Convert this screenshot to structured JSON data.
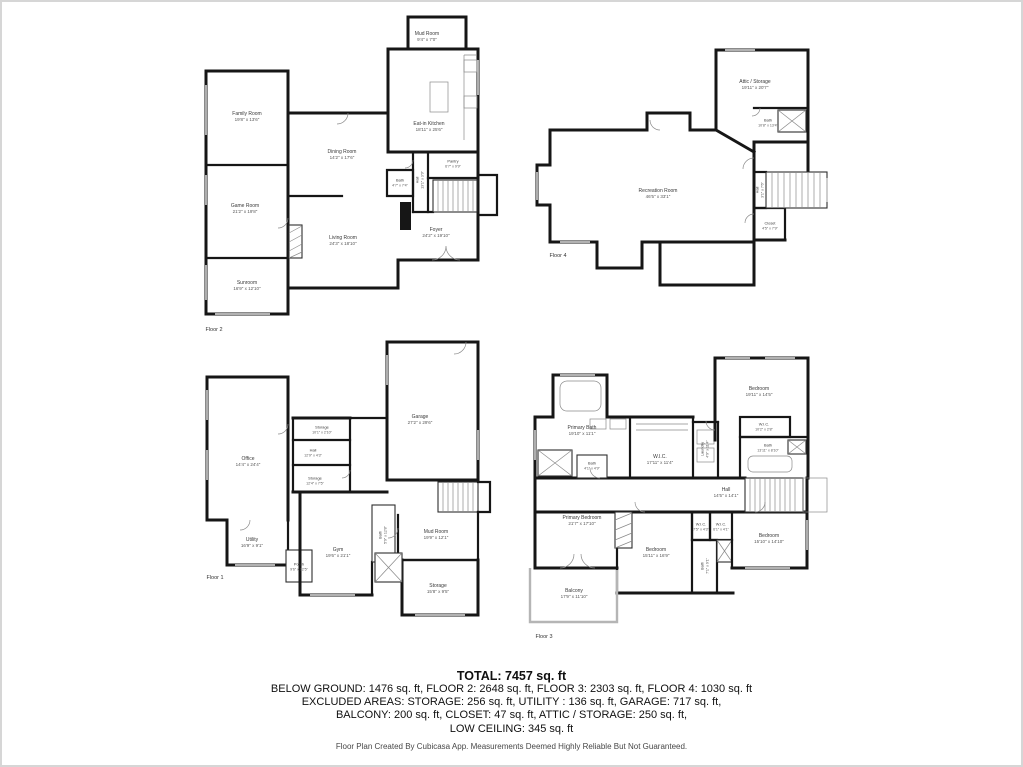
{
  "summary": {
    "total": "TOTAL: 7457 sq. ft",
    "line2": "BELOW GROUND: 1476 sq. ft, FLOOR 2: 2648 sq. ft, FLOOR 3: 2303 sq. ft, FLOOR 4: 1030 sq. ft",
    "line3": "EXCLUDED AREAS: STORAGE: 256 sq. ft, UTILITY : 136 sq. ft, GARAGE: 717 sq. ft,",
    "line4": "BALCONY: 200 sq. ft, CLOSET: 47 sq. ft, ATTIC / STORAGE: 250 sq. ft,",
    "line5": "LOW CEILING: 345 sq. ft"
  },
  "footer": "Floor Plan Created By Cubicasa App. Measurements Deemed Highly Reliable But Not Guaranteed.",
  "colors": {
    "wall": "#161616",
    "window_mark": "#c9c9c9",
    "light_wall": "#b5b5b5",
    "background": "#ffffff",
    "text": "#111111"
  },
  "floors": [
    {
      "label": "Floor 2",
      "rooms": [
        {
          "name": "Mud Room",
          "dims": "9'4\" x 7'0\""
        },
        {
          "name": "Eat-in Kitchen",
          "dims": "18'11\" x 25'6\""
        },
        {
          "name": "Family Room",
          "dims": "19'8\" x 13'6\""
        },
        {
          "name": "Dining Room",
          "dims": "14'2\" x 17'6\""
        },
        {
          "name": "Pantry",
          "dims": "6'7\" x 9'9\""
        },
        {
          "name": "Bath",
          "dims": "4'7\" x 7'4\""
        },
        {
          "name": "Hall",
          "dims": "13'1\" x 3'9\""
        },
        {
          "name": "Game Room",
          "dims": "21'2\" x 19'8\""
        },
        {
          "name": "Living Room",
          "dims": "24'3\" x 18'10\""
        },
        {
          "name": "Foyer",
          "dims": "24'2\" x 19'10\""
        },
        {
          "name": "Sunroom",
          "dims": "16'9\" x 12'10\""
        }
      ]
    },
    {
      "label": "Floor 4",
      "rooms": [
        {
          "name": "Attic / Storage",
          "dims": "19'11\" x 20'7\""
        },
        {
          "name": "Bath",
          "dims": "10'8\" x 13'4\""
        },
        {
          "name": "Recreation Room",
          "dims": "46'5\" x 33'1\""
        },
        {
          "name": "Hall",
          "dims": "3'1\" x 7'6\""
        },
        {
          "name": "Closet",
          "dims": "4'5\" x 7'9\""
        }
      ]
    },
    {
      "label": "Floor 1",
      "rooms": [
        {
          "name": "Office",
          "dims": "14'4\" x 24'4\""
        },
        {
          "name": "Garage",
          "dims": "27'2\" x 29'6\""
        },
        {
          "name": "Storage",
          "dims": "10'1\" x 2'10\""
        },
        {
          "name": "Hall",
          "dims": "12'9\" x 4'3\""
        },
        {
          "name": "Storage",
          "dims": "12'4\" x 7'5\""
        },
        {
          "name": "Utility",
          "dims": "16'9\" x 9'1\""
        },
        {
          "name": "Gym",
          "dims": "19'6\" x 21'1\""
        },
        {
          "name": "Bath",
          "dims": "5'9\" x 12'8\""
        },
        {
          "name": "Mud Room",
          "dims": "19'9\" x 12'1\""
        },
        {
          "name": "Storage",
          "dims": "15'8\" x 9'5\""
        },
        {
          "name": "Porch",
          "dims": "9'6\" x 12'5\""
        }
      ]
    },
    {
      "label": "Floor 3",
      "rooms": [
        {
          "name": "Primary Bath",
          "dims": "19'10\" x 11'1\""
        },
        {
          "name": "Bath",
          "dims": "4'1\" x 4'9\""
        },
        {
          "name": "W.I.C.",
          "dims": "17'11\" x 11'4\""
        },
        {
          "name": "Laundry",
          "dims": "4'9\" x 11'4\""
        },
        {
          "name": "Bedroom",
          "dims": "19'11\" x 14'5\""
        },
        {
          "name": "W.I.C.",
          "dims": "10'2\" x 2'8\""
        },
        {
          "name": "Bath",
          "dims": "13'11\" x 8'10\""
        },
        {
          "name": "Hall",
          "dims": "14'5\" x 14'1\""
        },
        {
          "name": "Primary Bedroom",
          "dims": "21'7\" x 17'10\""
        },
        {
          "name": "Bedroom",
          "dims": "15'11\" x 16'9\""
        },
        {
          "name": "W.I.C.",
          "dims": "7'5\" x 4'3\""
        },
        {
          "name": "W.I.C.",
          "dims": "6'1\" x 4'1\""
        },
        {
          "name": "Bath",
          "dims": "7'1\" x 9'1\""
        },
        {
          "name": "Bedroom",
          "dims": "15'10\" x 14'10\""
        },
        {
          "name": "Balcony",
          "dims": "17'9\" x 11'10\""
        }
      ]
    }
  ]
}
